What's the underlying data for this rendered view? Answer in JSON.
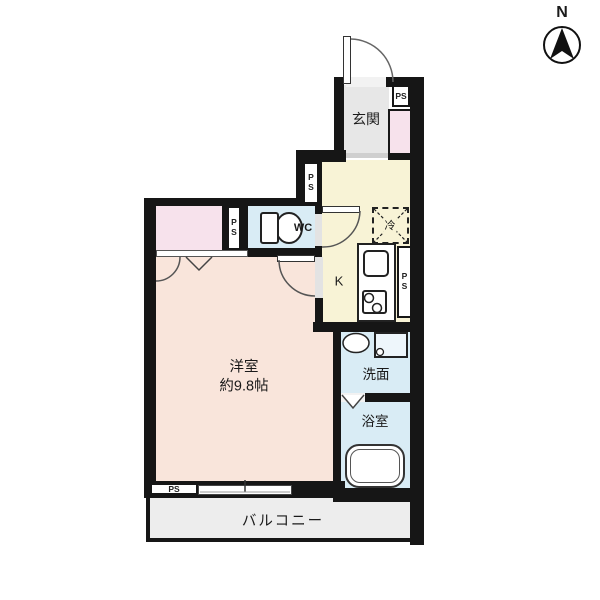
{
  "title": "floor-plan",
  "compass": {
    "label": "N"
  },
  "rooms": {
    "genkan": {
      "label": "玄関"
    },
    "wc": {
      "label": "WC"
    },
    "kitchen": {
      "label": "K"
    },
    "washroom": {
      "label": "洗面"
    },
    "bathroom": {
      "label": "浴室"
    },
    "main_room": {
      "label": "洋室",
      "size": "約9.8帖"
    },
    "balcony": {
      "label": "バルコニー"
    }
  },
  "annotations": {
    "pipe_space": "PS",
    "refrigerator": "冷"
  },
  "colors": {
    "wall": "#161616",
    "genkan_floor": "#e7e7e7",
    "closet_pink": "#f7e2ec",
    "kitchen_yellow": "#f8f3d6",
    "room_peach": "#f9e5db",
    "water_blue": "#d9ecf5",
    "balcony_gray": "#ededed"
  }
}
